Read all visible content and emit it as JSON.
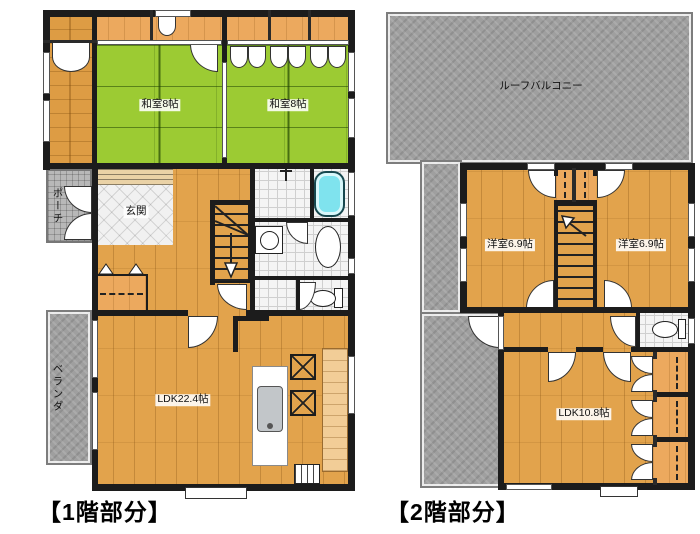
{
  "floor1": {
    "caption": "【1階部分】",
    "washitsu1": "和室8帖",
    "washitsu2": "和室8帖",
    "genkan": "玄関",
    "porch": "ポーチ",
    "veranda": "ベランダ",
    "ldk": "LDK22.4帖"
  },
  "floor2": {
    "caption": "【2階部分】",
    "roof_balcony": "ルーフバルコニー",
    "bedroom_left": "洋室6.9帖",
    "bedroom_right": "洋室6.9帖",
    "ldk": "LDK10.8帖"
  },
  "colors": {
    "wall": "#1c1c1c",
    "tatami_green": "#9ccb33",
    "wood_floor": "#e2a34c",
    "closet_wood": "#eca95e",
    "balcony_gray": "#9f9f9f",
    "tile_white": "#f4f4f4",
    "bathtub_cyan": "#7fe3ee"
  },
  "icons": {
    "bathtub": "rounded-rect",
    "toilet": "oval-with-tank",
    "washbasin": "oval",
    "washing_machine": "square-with-circle",
    "stove": "square-with-x",
    "kitchen_sink": "rounded-rect",
    "stairs_down_arrow": "down-arrow",
    "stairs_up_arrow": "up-left-arrow"
  }
}
